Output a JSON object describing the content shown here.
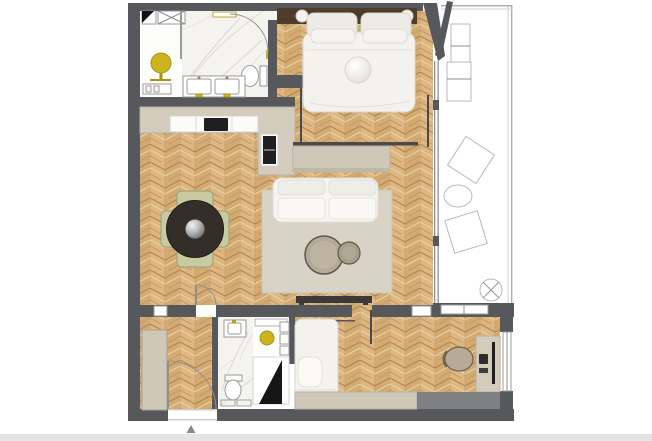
{
  "page": {
    "background": "#ffffff",
    "footer_strip_color": "#e4e4e4",
    "north_marker_shape": "small upward gray triangle below entrance"
  },
  "colors": {
    "wall": "#57585b",
    "wood_base": "#d3aa72",
    "wood_col_light": "#ddb681",
    "wood_grain_dark": "#b28851",
    "wood_grain_mid": "#c79c63",
    "wood_grain_light": "#e8d2a0",
    "marble": "#f5f3ef",
    "marble_vein": "#dcd8d0",
    "counter": "#d3cbbc",
    "counter_edge": "#b9b1a1",
    "cabinet": "#fbfbfa",
    "appliance": "#1f1f1f",
    "rug": "#d9d3c5",
    "sofa": "#f6f5f1",
    "console": "#cfc7b7",
    "table_dark": "#332e29",
    "chair_sage": "#c9caa2",
    "chair_border": "#a2a37b",
    "stool_gold": "#ccb41d",
    "bed_white": "#f3f2ee",
    "pillow": "#ecebe6",
    "headboard_wood": "#503c2b",
    "outline": "#b9b9b9",
    "glass": "#8f8f8f",
    "bench": "#cfc8b8",
    "unit_gray": "#7f8081",
    "door_panel_black": "#161616",
    "footer": "#e4e4e4",
    "arrow": "#8a8a8a"
  },
  "floor_plan": {
    "type": "apartment-floor-plan-top-view",
    "rooms": [
      {
        "id": "bathroom-main",
        "floor": "marble",
        "furniture": [
          "double-sink-vanity",
          "toilet",
          "shower-strip",
          "door-arc",
          "gold-accents"
        ]
      },
      {
        "id": "dressing-nook",
        "floor": "white",
        "furniture": [
          "gold-stool",
          "bench-rail",
          "shaft-x-box",
          "door-swing-symbol"
        ]
      },
      {
        "id": "bedroom-main",
        "floor": "chevron-wood",
        "furniture": [
          "double-bed",
          "four-pillows",
          "round-cushion",
          "wood-headboard",
          "bedside-lamp-left",
          "bedside-lamp-right",
          "sliding-track-left",
          "sliding-track-right"
        ]
      },
      {
        "id": "kitchen",
        "floor": "chevron-wood",
        "furniture": [
          "l-shaped-counter",
          "base-cabinets",
          "cooktop",
          "tall-oven-unit"
        ]
      },
      {
        "id": "dining-area",
        "floor": "chevron-wood",
        "furniture": [
          "round-dark-table",
          "silver-sphere-centerpiece",
          "chair-north",
          "chair-south",
          "chair-west",
          "chair-east"
        ]
      },
      {
        "id": "living-area",
        "floor": "chevron-wood",
        "furniture": [
          "sofa",
          "area-rug",
          "coffee-table-large",
          "coffee-table-small",
          "console-sideboard",
          "tv-console",
          "interior-door-arc",
          "wall-niche"
        ]
      },
      {
        "id": "entry-hall",
        "floor": "chevron-wood",
        "furniture": [
          "wardrobe",
          "entry-door-arc",
          "entry-threshold"
        ]
      },
      {
        "id": "bathroom-second",
        "floor": "marble",
        "furniture": [
          "sink",
          "toilet",
          "appliance-boxes"
        ]
      },
      {
        "id": "vestibule",
        "floor": "white",
        "furniture": [
          "gold-stool",
          "wall-shelves",
          "top-shelf",
          "black-door-panel"
        ]
      },
      {
        "id": "bedroom-second",
        "floor": "chevron-wood",
        "furniture": [
          "single-bed",
          "pillow",
          "hanging-rail",
          "desk",
          "desk-chair",
          "monitor",
          "laptop",
          "bench-cabinet",
          "gray-unit",
          "side-window"
        ]
      },
      {
        "id": "balcony",
        "floor": "white-outline",
        "furniture": [
          "railing",
          "lounge-chair-two-part",
          "tilted-chair-upper",
          "round-side-table",
          "tilted-chair-lower",
          "parasol-base-circle-x",
          "low-window",
          "angled-wall",
          "open-door-leaf"
        ]
      }
    ]
  }
}
